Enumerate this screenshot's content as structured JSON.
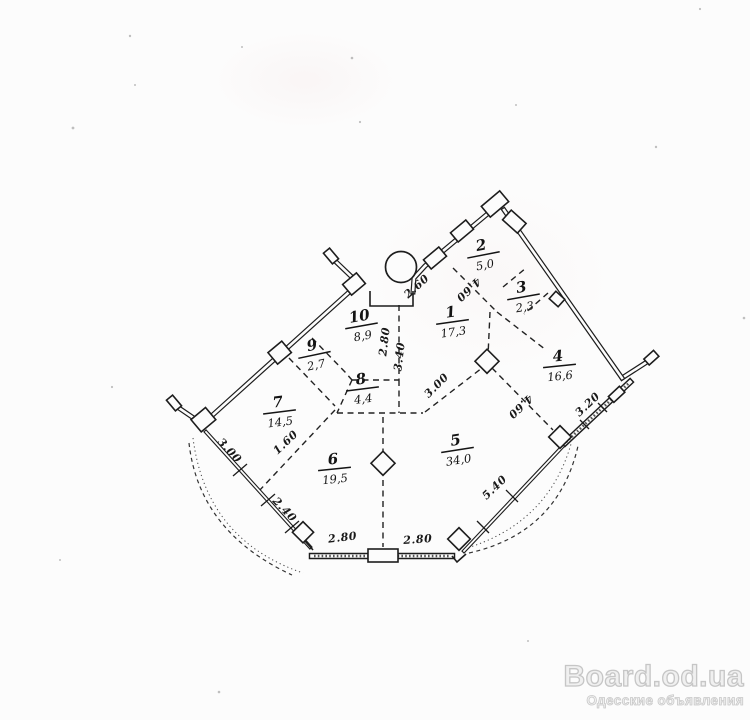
{
  "plan": {
    "rooms": [
      {
        "number": "1",
        "area": "17,3",
        "x": 452,
        "y": 322,
        "tilt": -8
      },
      {
        "number": "2",
        "area": "5,0",
        "x": 483,
        "y": 255,
        "tilt": -11
      },
      {
        "number": "3",
        "area": "2,3",
        "x": 523,
        "y": 297,
        "tilt": -10
      },
      {
        "number": "4",
        "area": "16,6",
        "x": 559,
        "y": 366,
        "tilt": -6
      },
      {
        "number": "5",
        "area": "34,0",
        "x": 457,
        "y": 450,
        "tilt": -9
      },
      {
        "number": "6",
        "area": "19,5",
        "x": 334,
        "y": 469,
        "tilt": -6
      },
      {
        "number": "7",
        "area": "14,5",
        "x": 279,
        "y": 412,
        "tilt": -7
      },
      {
        "number": "8",
        "area": "4,4",
        "x": 362,
        "y": 389,
        "tilt": -7
      },
      {
        "number": "9",
        "area": "2,7",
        "x": 314,
        "y": 355,
        "tilt": -12
      },
      {
        "number": "10",
        "area": "8,9",
        "x": 361,
        "y": 326,
        "tilt": -10
      }
    ],
    "dimensions": [
      {
        "text": "2.60",
        "x": 419,
        "y": 289,
        "rot": -42
      },
      {
        "text": "4.60",
        "x": 466,
        "y": 287,
        "rot": 137
      },
      {
        "text": "4.60",
        "x": 518,
        "y": 404,
        "rot": 137
      },
      {
        "text": "3.00",
        "x": 439,
        "y": 388,
        "rot": -45
      },
      {
        "text": "2.80",
        "x": 388,
        "y": 342,
        "rot": -83
      },
      {
        "text": "3.40",
        "x": 403,
        "y": 357,
        "rot": -83
      },
      {
        "text": "1.60",
        "x": 288,
        "y": 445,
        "rot": -43
      },
      {
        "text": "3.00",
        "x": 227,
        "y": 453,
        "rot": 47
      },
      {
        "text": "2.40",
        "x": 282,
        "y": 512,
        "rot": 47
      },
      {
        "text": "2.80",
        "x": 343,
        "y": 541,
        "rot": -7
      },
      {
        "text": "2.80",
        "x": 418,
        "y": 543,
        "rot": -4
      },
      {
        "text": "5.40",
        "x": 497,
        "y": 490,
        "rot": -44
      },
      {
        "text": "3.20",
        "x": 590,
        "y": 407,
        "rot": -43
      }
    ]
  },
  "watermark": {
    "title": "Board.od.ua",
    "subtitle": "Одесские объявления"
  }
}
